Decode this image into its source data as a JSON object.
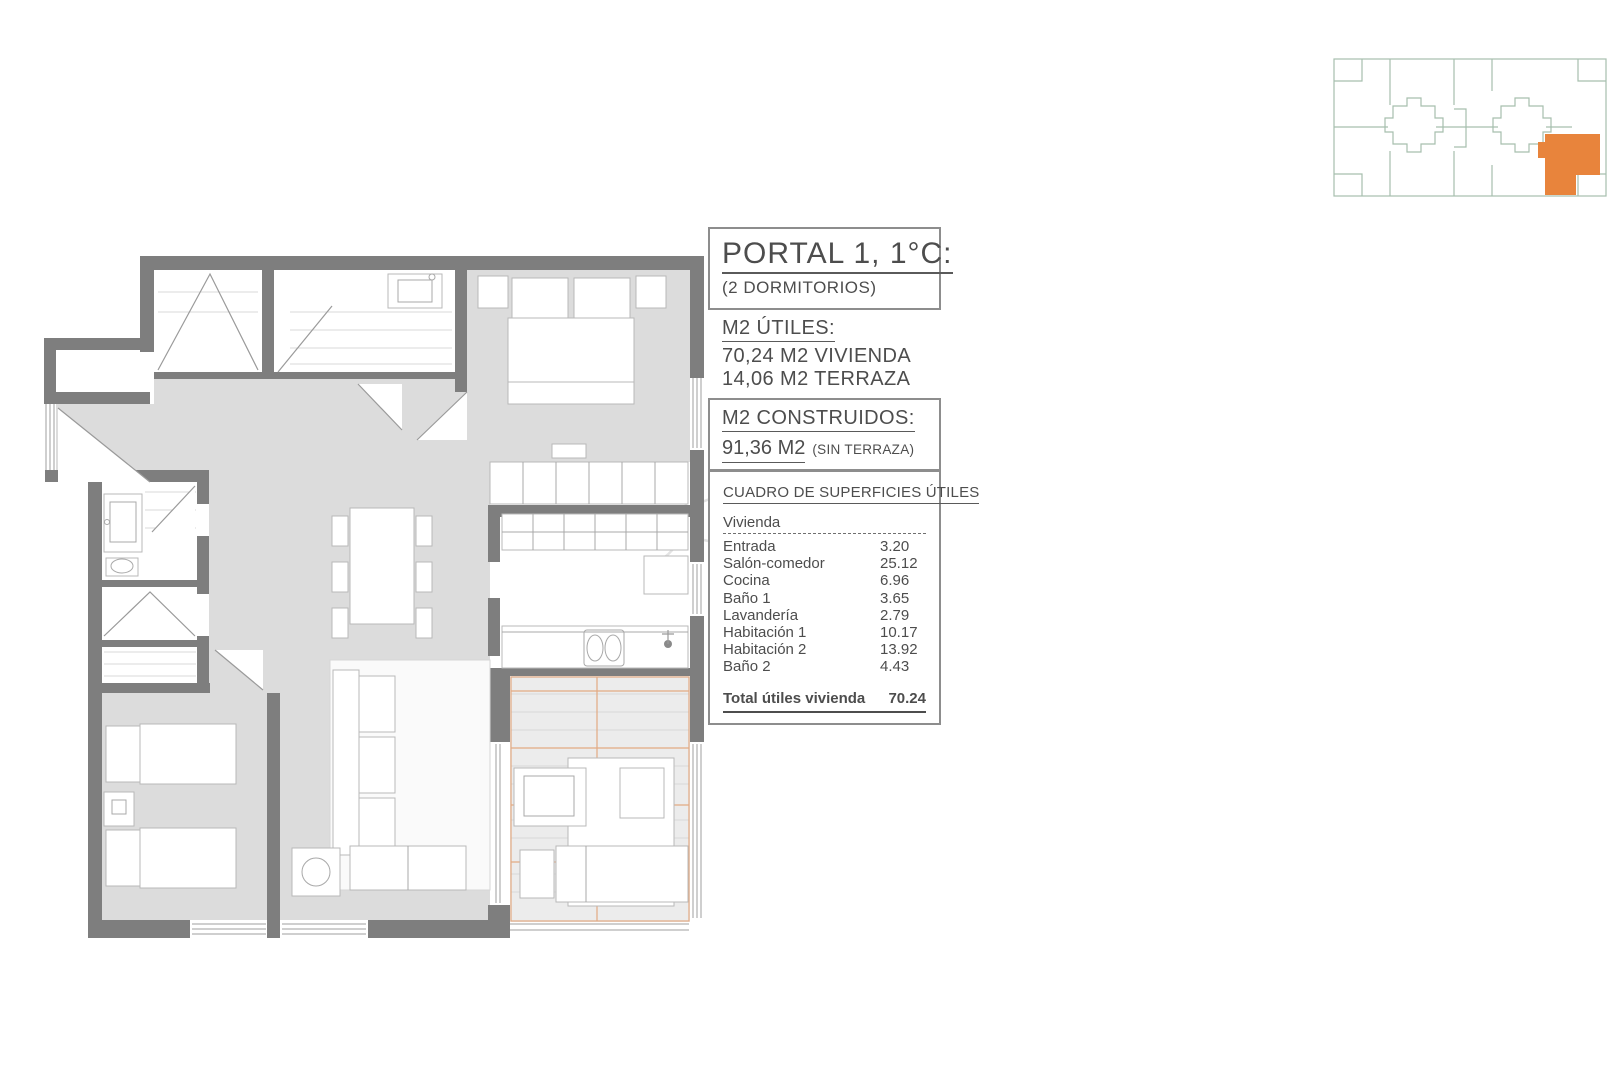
{
  "unit": {
    "title": "PORTAL 1, 1°C:",
    "subtitle": "(2 DORMITORIOS)"
  },
  "usable": {
    "heading": "M2 ÚTILES:",
    "lines": [
      "70,24 M2 VIVIENDA",
      "14,06 M2 TERRAZA"
    ]
  },
  "built": {
    "heading": "M2 CONSTRUIDOS:",
    "value": "91,36 M2",
    "note": "(SIN TERRAZA)"
  },
  "areas_table": {
    "heading": "CUADRO DE SUPERFICIES ÚTILES",
    "group": "Vivienda",
    "rows": [
      {
        "label": "Entrada",
        "value": "3.20"
      },
      {
        "label": "Salón-comedor",
        "value": "25.12"
      },
      {
        "label": "Cocina",
        "value": "6.96"
      },
      {
        "label": "Baño 1",
        "value": "3.65"
      },
      {
        "label": "Lavandería",
        "value": "2.79"
      },
      {
        "label": "Habitación 1",
        "value": "10.17"
      },
      {
        "label": "Habitación 2",
        "value": "13.92"
      },
      {
        "label": "Baño 2",
        "value": "4.43"
      }
    ],
    "total_label": "Total útiles vivienda",
    "total_value": "70.24"
  },
  "colors": {
    "highlight_orange": "#E8843C",
    "key_plan_outline": "#A6BFAE",
    "wall_gray": "#7E7E7E",
    "floor_gray": "#DCDCDC",
    "terrace_tile_orange": "#E2A378"
  }
}
